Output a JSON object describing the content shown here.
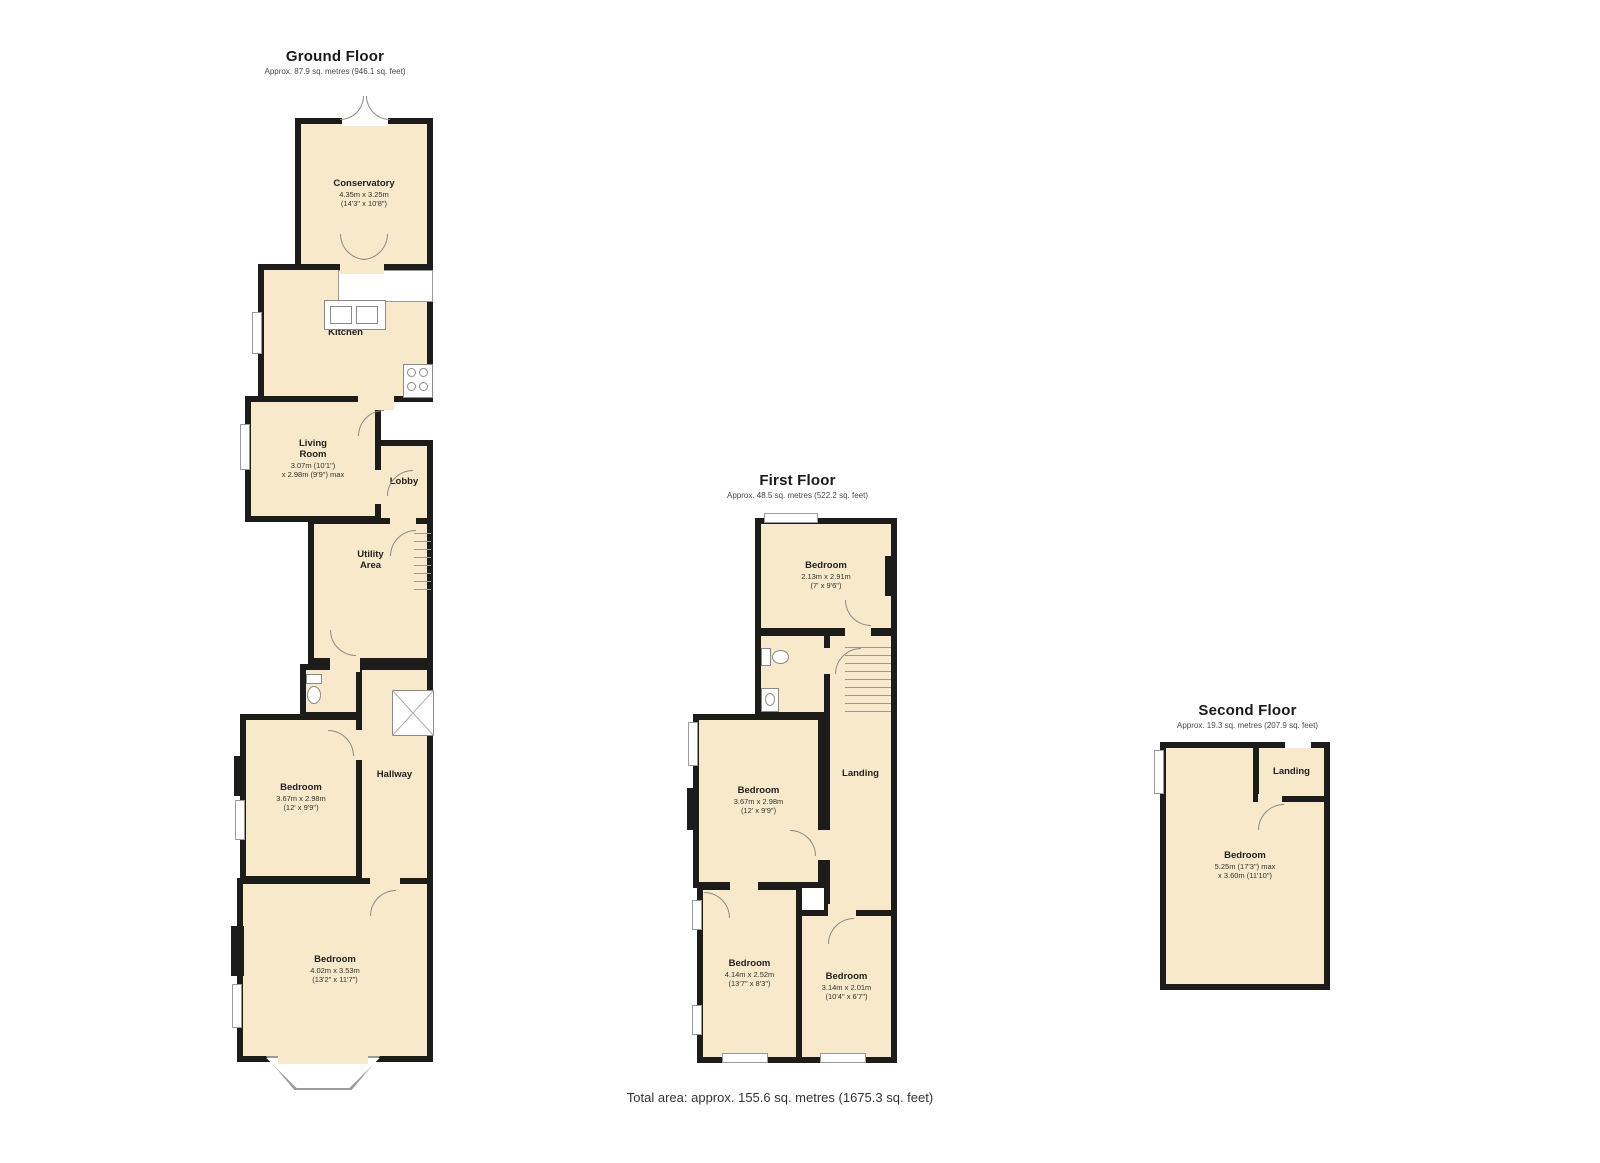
{
  "colors": {
    "room_fill": "#F7E9C9",
    "wall": "#1C1C1A",
    "outline": "#9A9A9A"
  },
  "floors": {
    "ground": {
      "title": "Ground Floor",
      "subtitle": "Approx. 87.9 sq. metres (946.1 sq. feet)",
      "rooms": {
        "conservatory": {
          "name": "Conservatory",
          "dims1": "4.35m x 3.25m",
          "dims2": "(14'3\" x 10'8\")"
        },
        "kitchen": {
          "name": "Kitchen"
        },
        "living_room": {
          "name": "Living Room",
          "dims1": "3.07m (10'1\")",
          "dims2": "x 2.98m (9'9\") max"
        },
        "lobby": {
          "name": "Lobby"
        },
        "utility": {
          "name": "Utility Area"
        },
        "bedroom_front_small": {
          "name": "Bedroom",
          "dims1": "3.67m x 2.98m",
          "dims2": "(12' x 9'9\")"
        },
        "hallway": {
          "name": "Hallway"
        },
        "bedroom_front_large": {
          "name": "Bedroom",
          "dims1": "4.02m x 3.53m",
          "dims2": "(13'2\" x 11'7\")"
        }
      }
    },
    "first": {
      "title": "First Floor",
      "subtitle": "Approx. 48.5 sq. metres (522.2 sq. feet)",
      "rooms": {
        "bedroom_rear": {
          "name": "Bedroom",
          "dims1": "2.13m x 2.91m",
          "dims2": "(7' x 9'6\")"
        },
        "bedroom_middle": {
          "name": "Bedroom",
          "dims1": "3.67m x 2.98m",
          "dims2": "(12' x 9'9\")"
        },
        "landing": {
          "name": "Landing"
        },
        "bedroom_front_left": {
          "name": "Bedroom",
          "dims1": "4.14m x 2.52m",
          "dims2": "(13'7\" x 8'3\")"
        },
        "bedroom_front_right": {
          "name": "Bedroom",
          "dims1": "3.14m x 2.01m",
          "dims2": "(10'4\" x 6'7\")"
        }
      }
    },
    "second": {
      "title": "Second Floor",
      "subtitle": "Approx. 19.3 sq. metres (207.9 sq. feet)",
      "rooms": {
        "landing": {
          "name": "Landing"
        },
        "bedroom": {
          "name": "Bedroom",
          "dims1": "5.25m (17'3\") max",
          "dims2": "x 3.60m (11'10\")"
        }
      }
    }
  },
  "footer": {
    "total_area": "Total area: approx. 155.6 sq. metres (1675.3 sq. feet)"
  }
}
